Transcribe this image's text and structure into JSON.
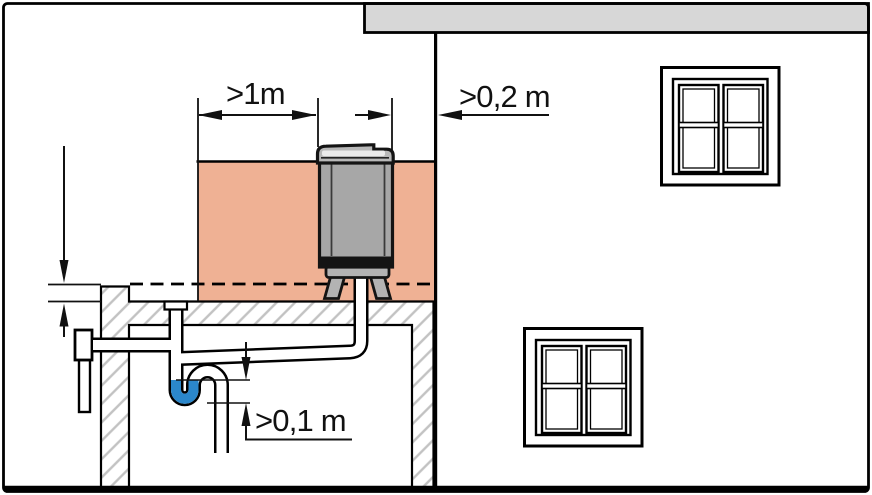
{
  "diagram": {
    "type": "installation-clearance-diagram",
    "subject": "heat-pump on flat roof with condensate siphon drain",
    "labels": {
      "min_distance_side": ">1m",
      "min_distance_wall": ">0,2 m",
      "min_trap_seal_height": ">0,1 m"
    },
    "colors": {
      "line": "#000000",
      "backdrop_wall_fill": "#efb194",
      "unit_body_gray": "#a7a7a7",
      "unit_stand_gray": "#b3b3b3",
      "roof_eave_gray": "#d7d7d7",
      "hatch_line_gray": "#c2c2c2",
      "trap_water_blue": "#2b87cb"
    }
  }
}
